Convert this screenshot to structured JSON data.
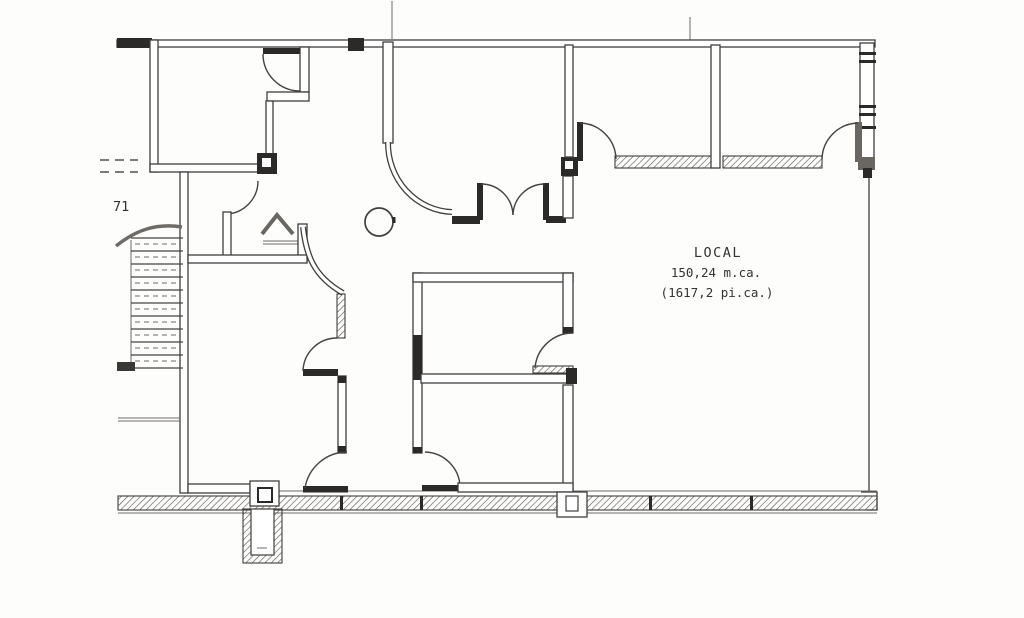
{
  "plan": {
    "labels": {
      "local_title": "LOCAL",
      "local_area_metric": "150,24 m.ca.",
      "local_area_imperial": "(1617,2 pi.ca.)",
      "stair_number": "71"
    },
    "colors": {
      "line": "#413f3c",
      "dark_fill": "#2b2a28",
      "hatch": "#57534e",
      "background": "#fdfdfc"
    }
  }
}
